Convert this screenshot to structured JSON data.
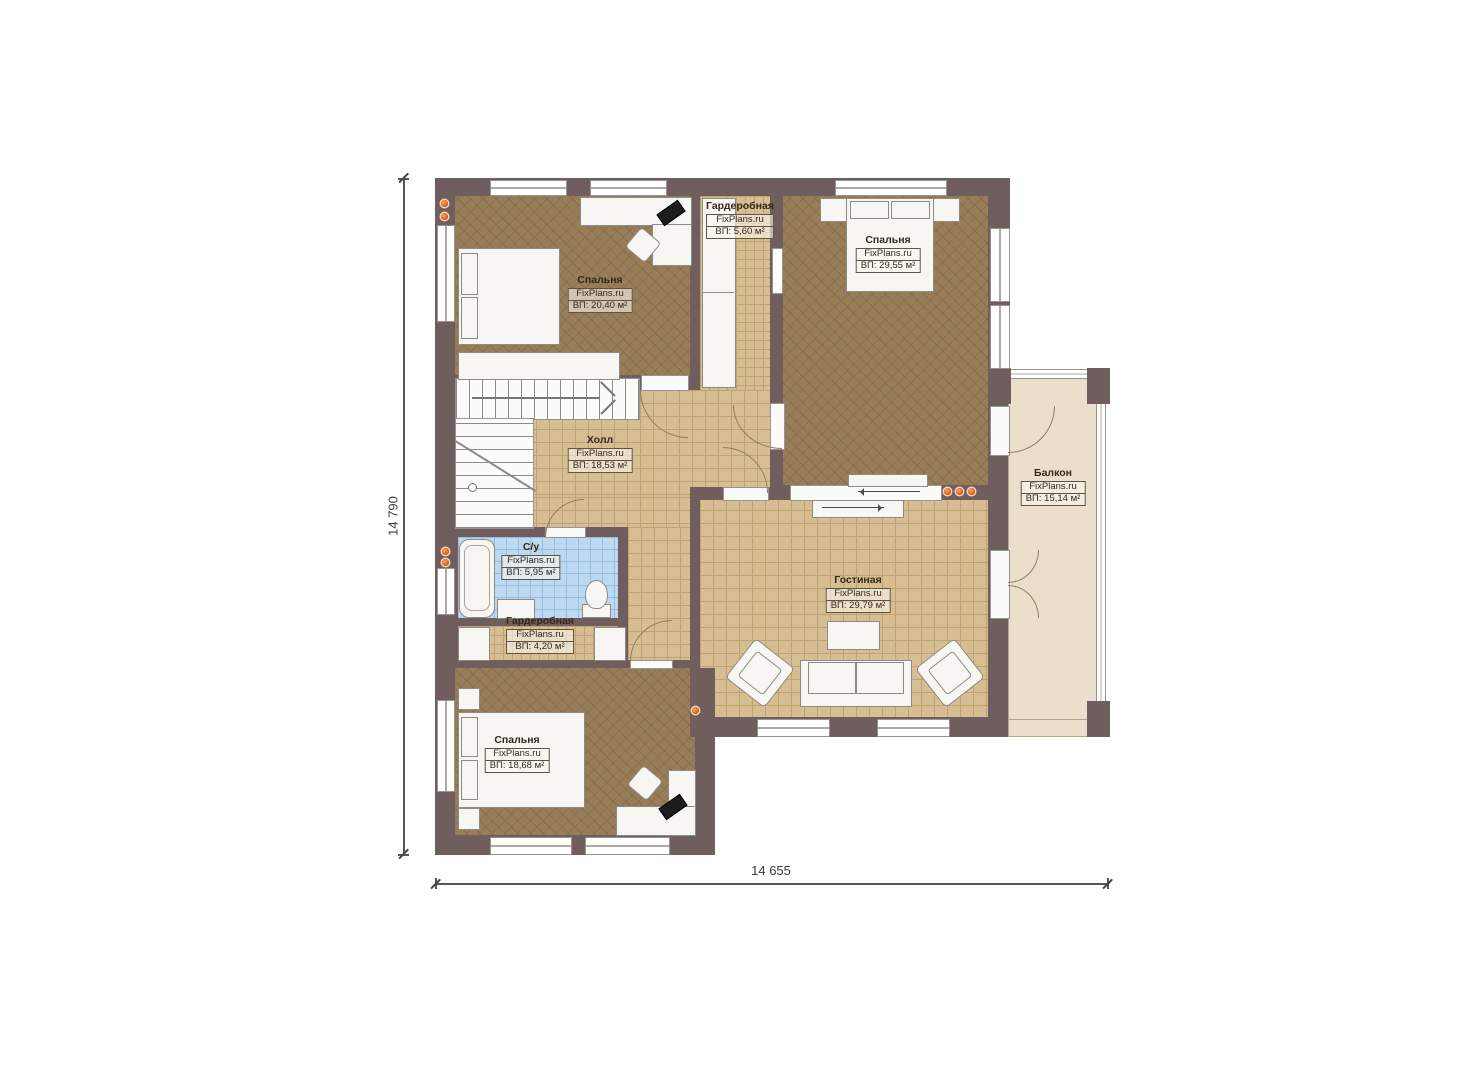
{
  "plan": {
    "brand": "FixPlans.ru",
    "rooms": [
      {
        "name": "Спальня",
        "brand": "FixPlans.ru",
        "area": "ВП: 20,40 м²"
      },
      {
        "name": "Гардеробная",
        "brand": "FixPlans.ru",
        "area": "ВП: 5,60 м²"
      },
      {
        "name": "Спальня",
        "brand": "FixPlans.ru",
        "area": "ВП: 29,55 м²"
      },
      {
        "name": "Холл",
        "brand": "FixPlans.ru",
        "area": "ВП: 18,53 м²"
      },
      {
        "name": "Балкон",
        "brand": "FixPlans.ru",
        "area": "ВП: 15,14 м²"
      },
      {
        "name": "С/у",
        "brand": "FixPlans.ru",
        "area": "ВП: 5,95 м²"
      },
      {
        "name": "Гардеробная",
        "brand": "FixPlans.ru",
        "area": "ВП: 4,20 м²"
      },
      {
        "name": "Гостиная",
        "brand": "FixPlans.ru",
        "area": "ВП: 29,79 м²"
      },
      {
        "name": "Спальня",
        "brand": "FixPlans.ru",
        "area": "ВП: 18,68 м²"
      }
    ],
    "dimensions": {
      "height": "14 790",
      "width": "14 655"
    },
    "colors": {
      "wall": "#705d5e",
      "floor_bedroom": "#977d58",
      "floor_tile": "#d7bd92",
      "floor_bathroom": "#bdd9f2",
      "floor_balcony": "#eadfca",
      "spotlight": "#e8660f"
    }
  }
}
